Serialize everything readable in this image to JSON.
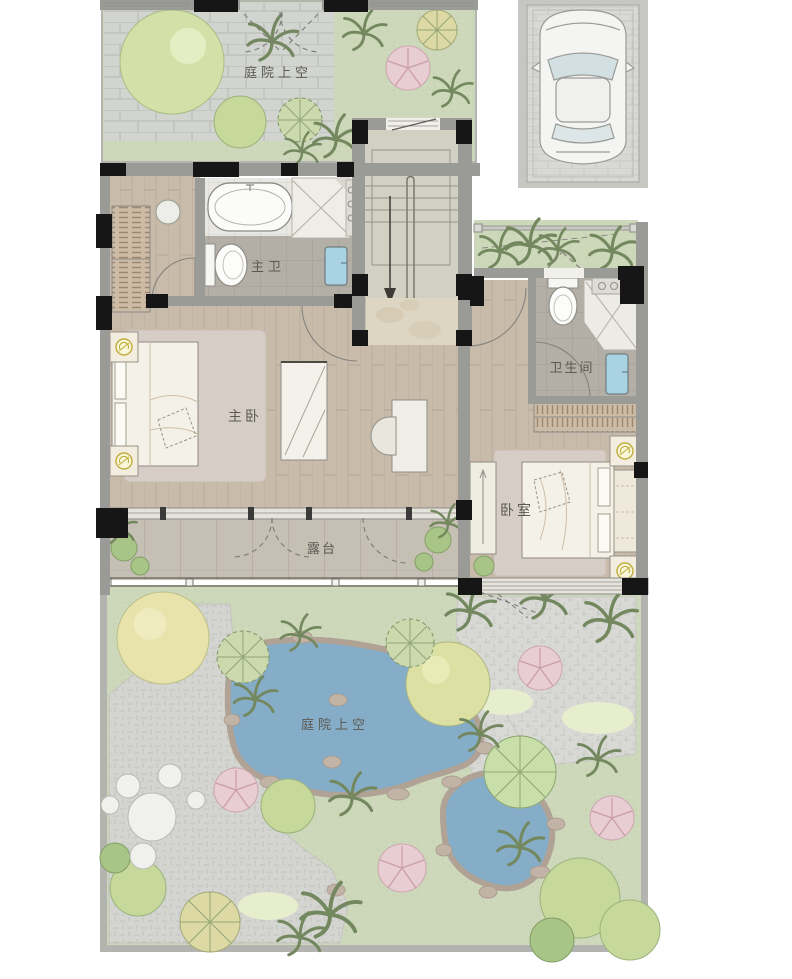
{
  "floorplan": {
    "labels": {
      "courtyard_top": "庭院上空",
      "master_bath": "主卫",
      "bathroom": "卫生间",
      "master_bedroom": "主卧",
      "bedroom": "卧室",
      "terrace": "露台",
      "garden_courtyard": "庭院上空"
    },
    "colors": {
      "lawn": "#cdd7ba",
      "stone_paving": "#d2d4cf",
      "wood_floor": "#c8bbaa",
      "bath_tile": "#b4afa6",
      "terrace_floor": "#c7c0b5",
      "wall_gray": "#9a9a96",
      "column_black": "#161616",
      "pond_water": "#86adc7",
      "marble_landing": "#ddd6c3",
      "plaza_paving": "#d4d5d1",
      "tree_green": "#c6d89a",
      "tree_yellow": "#e7e3ab",
      "tree_pink": "#e8cdd3",
      "sink_blue": "#a9d3e2",
      "lamp_accent": "#bfae3e",
      "car_body": "#f4f5f3"
    }
  }
}
